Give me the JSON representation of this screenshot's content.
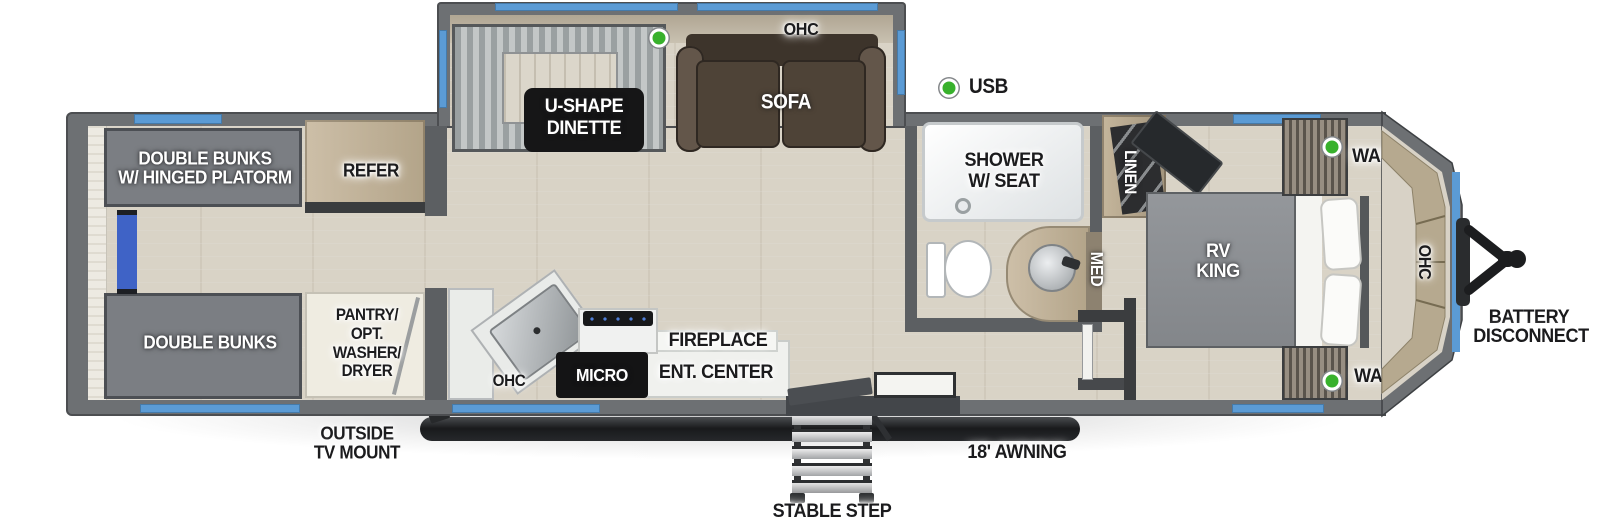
{
  "legend": {
    "usb_label": "USB",
    "battery_line1": "BATTERY",
    "battery_line2": "DISCONNECT",
    "outside_tv_line1": "OUTSIDE",
    "outside_tv_line2": "TV MOUNT",
    "awning_label": "18' AWNING",
    "step_label": "STABLE STEP"
  },
  "slide_out": {
    "ohc_label": "OHC",
    "dinette_line1": "U-SHAPE",
    "dinette_line2": "DINETTE",
    "sofa_label": "SOFA"
  },
  "bunk_room": {
    "top_bunk_line1": "DOUBLE BUNKS",
    "top_bunk_line2": "W/ HINGED PLATORM",
    "bottom_bunk_label": "DOUBLE BUNKS",
    "refrigerator_label": "REFER",
    "pantry_line1": "PANTRY/",
    "pantry_line2": "OPT.",
    "pantry_line3": "WASHER/",
    "pantry_line4": "DRYER"
  },
  "kitchen": {
    "ohc_label": "OHC",
    "microwave_label": "MICRO",
    "fireplace_label": "FIREPLACE",
    "ent_center_label": "ENT. CENTER"
  },
  "bathroom": {
    "shower_line1": "SHOWER",
    "shower_line2": "W/ SEAT",
    "linen_label": "LINEN",
    "med_label": "MED"
  },
  "bedroom": {
    "bed_line1": "RV",
    "bed_line2": "KING",
    "ward_top_label": "WARD",
    "ward_bottom_label": "WARD",
    "ohc_label": "OHC"
  },
  "colors": {
    "window_blue": "#5b9bd5",
    "wall_gray": "#6d7073",
    "floor_tan": "#d9d3c6",
    "usb_green": "#38b12c",
    "ladder_blue": "#3f63c6",
    "sofa_brown": "#4e4337",
    "cabinet_tan": "#b9ab94",
    "label_box_black": "#161617"
  }
}
